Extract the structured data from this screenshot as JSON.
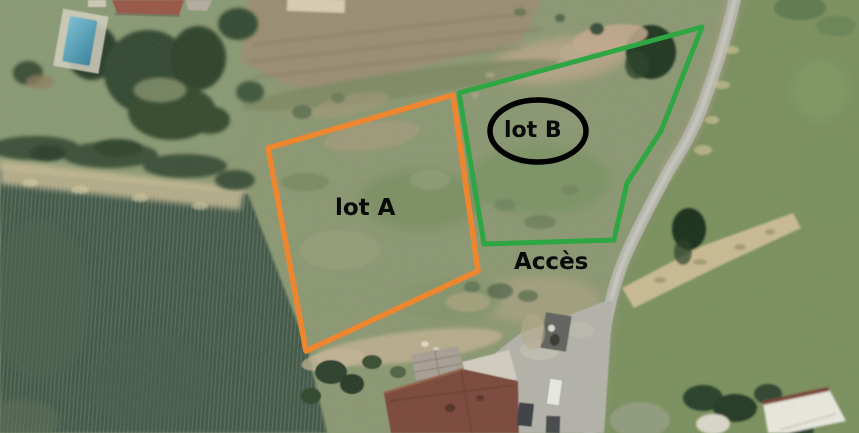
{
  "map": {
    "description": "Aerial satellite view of two adjoining land parcels with road access",
    "terrain_colors": {
      "grass_base": "#8d9874",
      "crop_field_dark": "#43594a",
      "plowed_field_tan": "#9b8f74",
      "bare_soil_strip": "#cabb94",
      "road_grey": "#b7b7af",
      "tree_dark_green": "#2e432c",
      "pool_blue": "#4f9cb4",
      "red_roof": "#7c4a3c"
    }
  },
  "annotations": {
    "lot_a": {
      "label": "lot A",
      "outline_color": "#ee8630"
    },
    "lot_b": {
      "label": "lot B",
      "outline_color": "#2ea643",
      "circle_color": "#000000"
    },
    "access": {
      "label": "Accès",
      "text_color": "#000000"
    }
  }
}
